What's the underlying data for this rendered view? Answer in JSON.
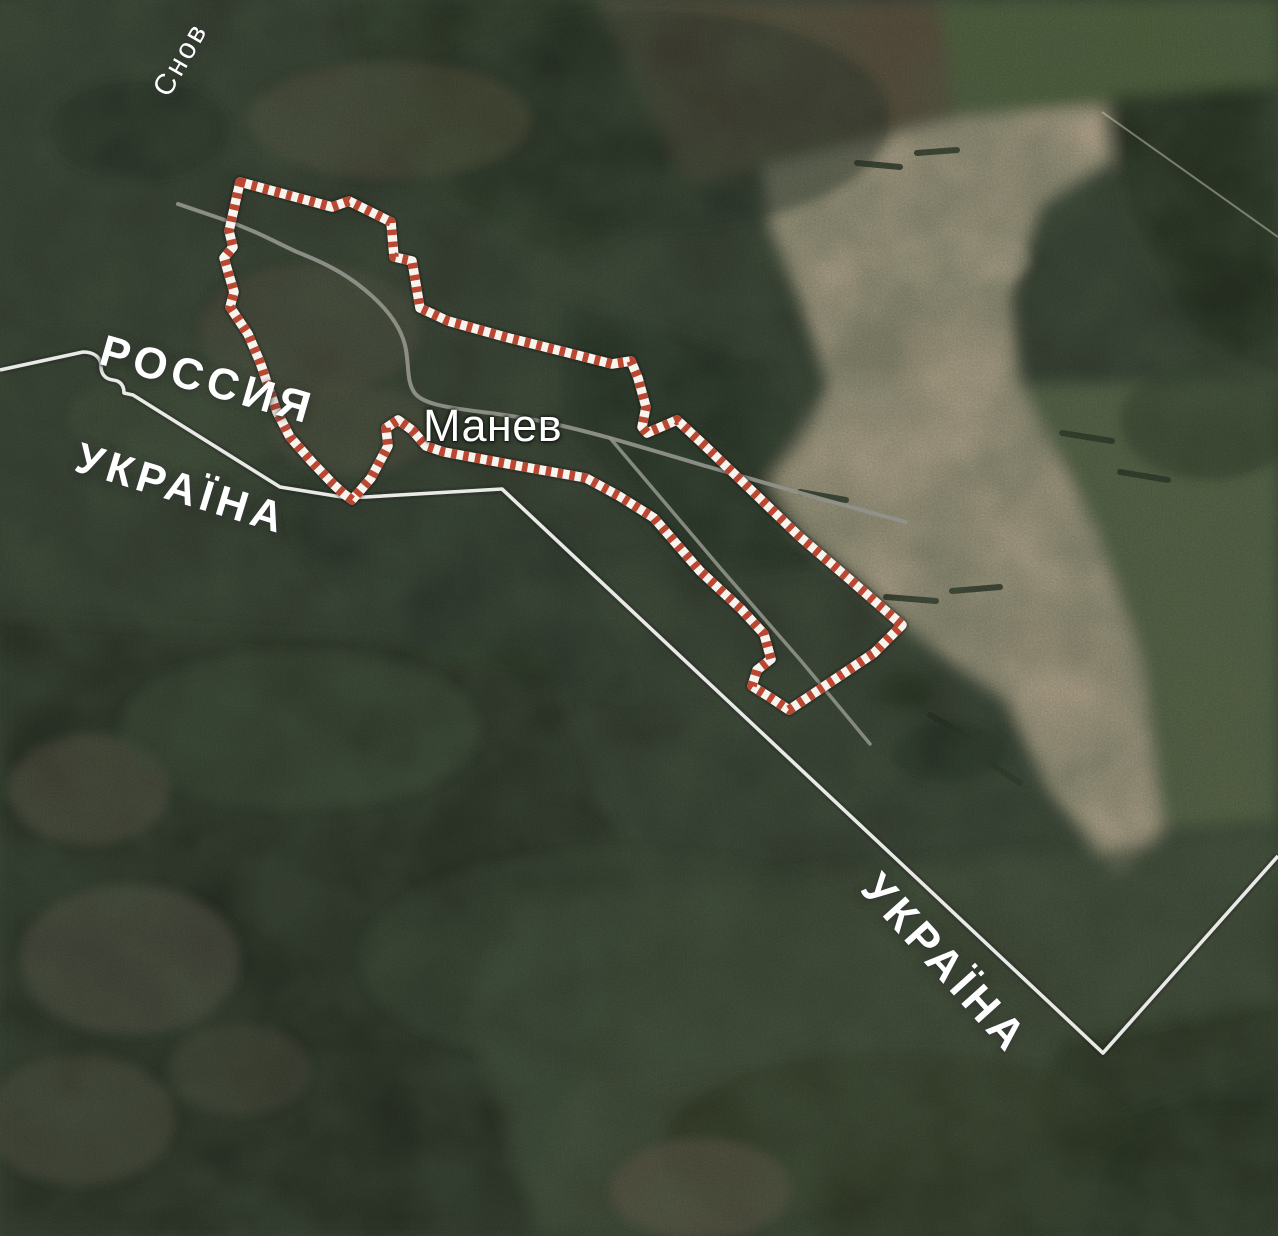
{
  "map": {
    "description": "Satellite view of the Russia–Ukraine border at the village of Manev; settlement area outlined with red-and-white hazard stripes",
    "labels": {
      "river": "Снов",
      "country_russia": "РОССИЯ",
      "country_ukraine_west": "УКРАЇНА",
      "country_ukraine_southeast": "УКРАЇНА",
      "settlement": "Манев"
    },
    "highlight": {
      "outlined_area": "Манев",
      "stripe_red": "#bb4733",
      "stripe_white": "#f7f4ee"
    },
    "colors": {
      "terrain_base": "#333b2f",
      "forest_dark": "#242d20",
      "field_tan": "#b6a78f",
      "field_brown": "#5e503e",
      "field_green_bright": "#53653e",
      "grass_green": "#5c694a",
      "border_line": "#e9e9e6",
      "road": "#90928a",
      "label_text": "#ffffff"
    },
    "geometry": {
      "outline_d": "M 240 182 L 332 207 L 349 201 L 391 222 L 394 257 L 412 261 L 420 308 L 448 321 L 505 337 L 565 352 L 612 364 L 631 361 L 638 378 L 646 407 L 642 427 L 647 433 L 677 420 L 703 444 L 750 489 L 800 537 L 848 578 L 902 625 L 874 653 L 789 710 L 771 698 L 752 686 L 757 670 L 771 659 L 764 634 L 741 609 L 700 571 L 654 518 L 619 496 L 586 478 L 519 466 L 444 452 L 426 446 L 412 430 L 398 420 L 386 428 L 388 446 L 371 478 L 352 500 L 344 494 L 333 484 L 312 462 L 290 437 L 277 412 L 260 362 L 248 334 L 230 307 L 234 292 L 224 258 L 233 247 L 229 231 Z",
      "border_d": "M 0 370 L 83 352 C 95 352 101 358 101 366 C 101 374 105 379 113 380 C 121 381 124 386 124 393 L 133 395 L 280 487 L 348 498 L 502 489 L 1103 1053 L 1278 856",
      "road_main_d": "M 178 204 L 222 219 C 262 233 282 246 302 254 C 332 266 352 278 372 296 C 392 314 403 332 406 350 C 409 368 407 381 414 392 C 421 403 442 407 482 412 C 532 418 562 425 610 438 C 652 450 682 459 702 465 C 762 482 852 508 906 522",
      "road_corridor_d": "M 610 438 L 722 570 L 802 662 L 870 744",
      "track_d": "M 1102 112 L 1278 237"
    }
  }
}
